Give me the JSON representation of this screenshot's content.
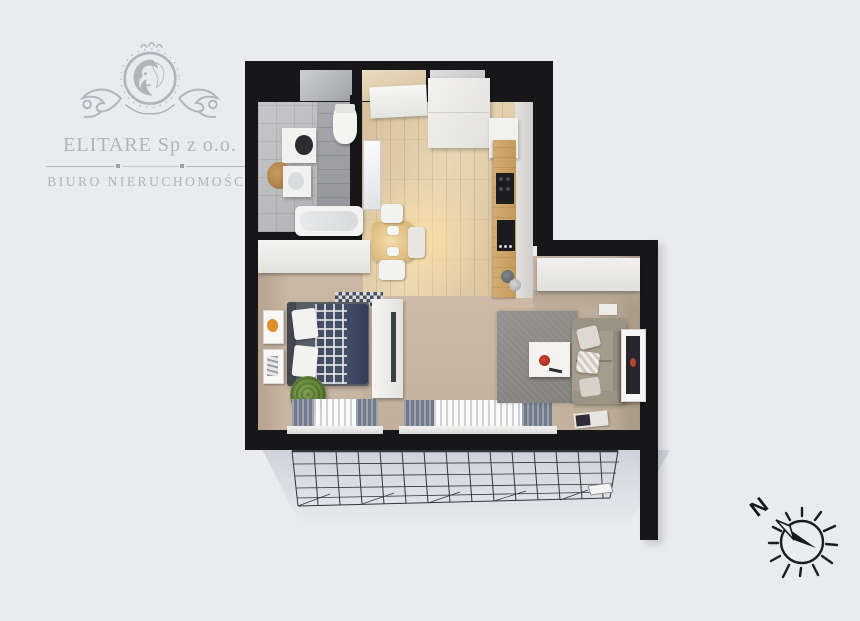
{
  "branding": {
    "company_name": "ELITARE Sp z o.o.",
    "tagline": "BIURO NIERUCHOMOŚCI",
    "logo_icon": "lion-crest-icon",
    "logo_color": "#b1b4bb"
  },
  "compass": {
    "north_label": "N",
    "icon": "compass-north-icon"
  },
  "floor_plan": {
    "type": "apartment-top-down-3d-render",
    "orientation": "north-up-left",
    "rooms": [
      {
        "name": "bathroom",
        "furniture": [
          "washing-machine",
          "sink-vanity",
          "wooden-stool",
          "toilet",
          "bathtub"
        ]
      },
      {
        "name": "entrance-hall",
        "furniture": [
          "shoe-cabinet",
          "tall-wardrobe",
          "mirror"
        ]
      },
      {
        "name": "kitchen",
        "furniture": [
          "counter",
          "cooktop",
          "sink",
          "coffee-machine",
          "upper-cabinet"
        ]
      },
      {
        "name": "dining-area",
        "furniture": [
          "square-wooden-table",
          "chair",
          "chair",
          "chair",
          "pendant-light"
        ]
      },
      {
        "name": "sleeping-area",
        "furniture": [
          "double-bed",
          "plaid-blanket",
          "pillows",
          "tv-unit",
          "green-pouf",
          "wall-frames",
          "checkered-rug",
          "closet"
        ]
      },
      {
        "name": "living-area",
        "furniture": [
          "sofa",
          "coffee-table",
          "grey-rug",
          "sideboard",
          "wall-art",
          "magazine"
        ]
      },
      {
        "name": "balcony",
        "furniture": [
          "wireframe-railing"
        ]
      }
    ],
    "windows": 2,
    "colors": {
      "background": "#e9ebee",
      "walls": "#17171a",
      "wood_floor": "#e0caa6",
      "beige_floor": "#c6b4a1",
      "bathroom_tiles": "#b4b5b8",
      "navy_bedding": "#3a445e",
      "green_pouf": "#5b7d34",
      "red_accent": "#b03226"
    }
  }
}
